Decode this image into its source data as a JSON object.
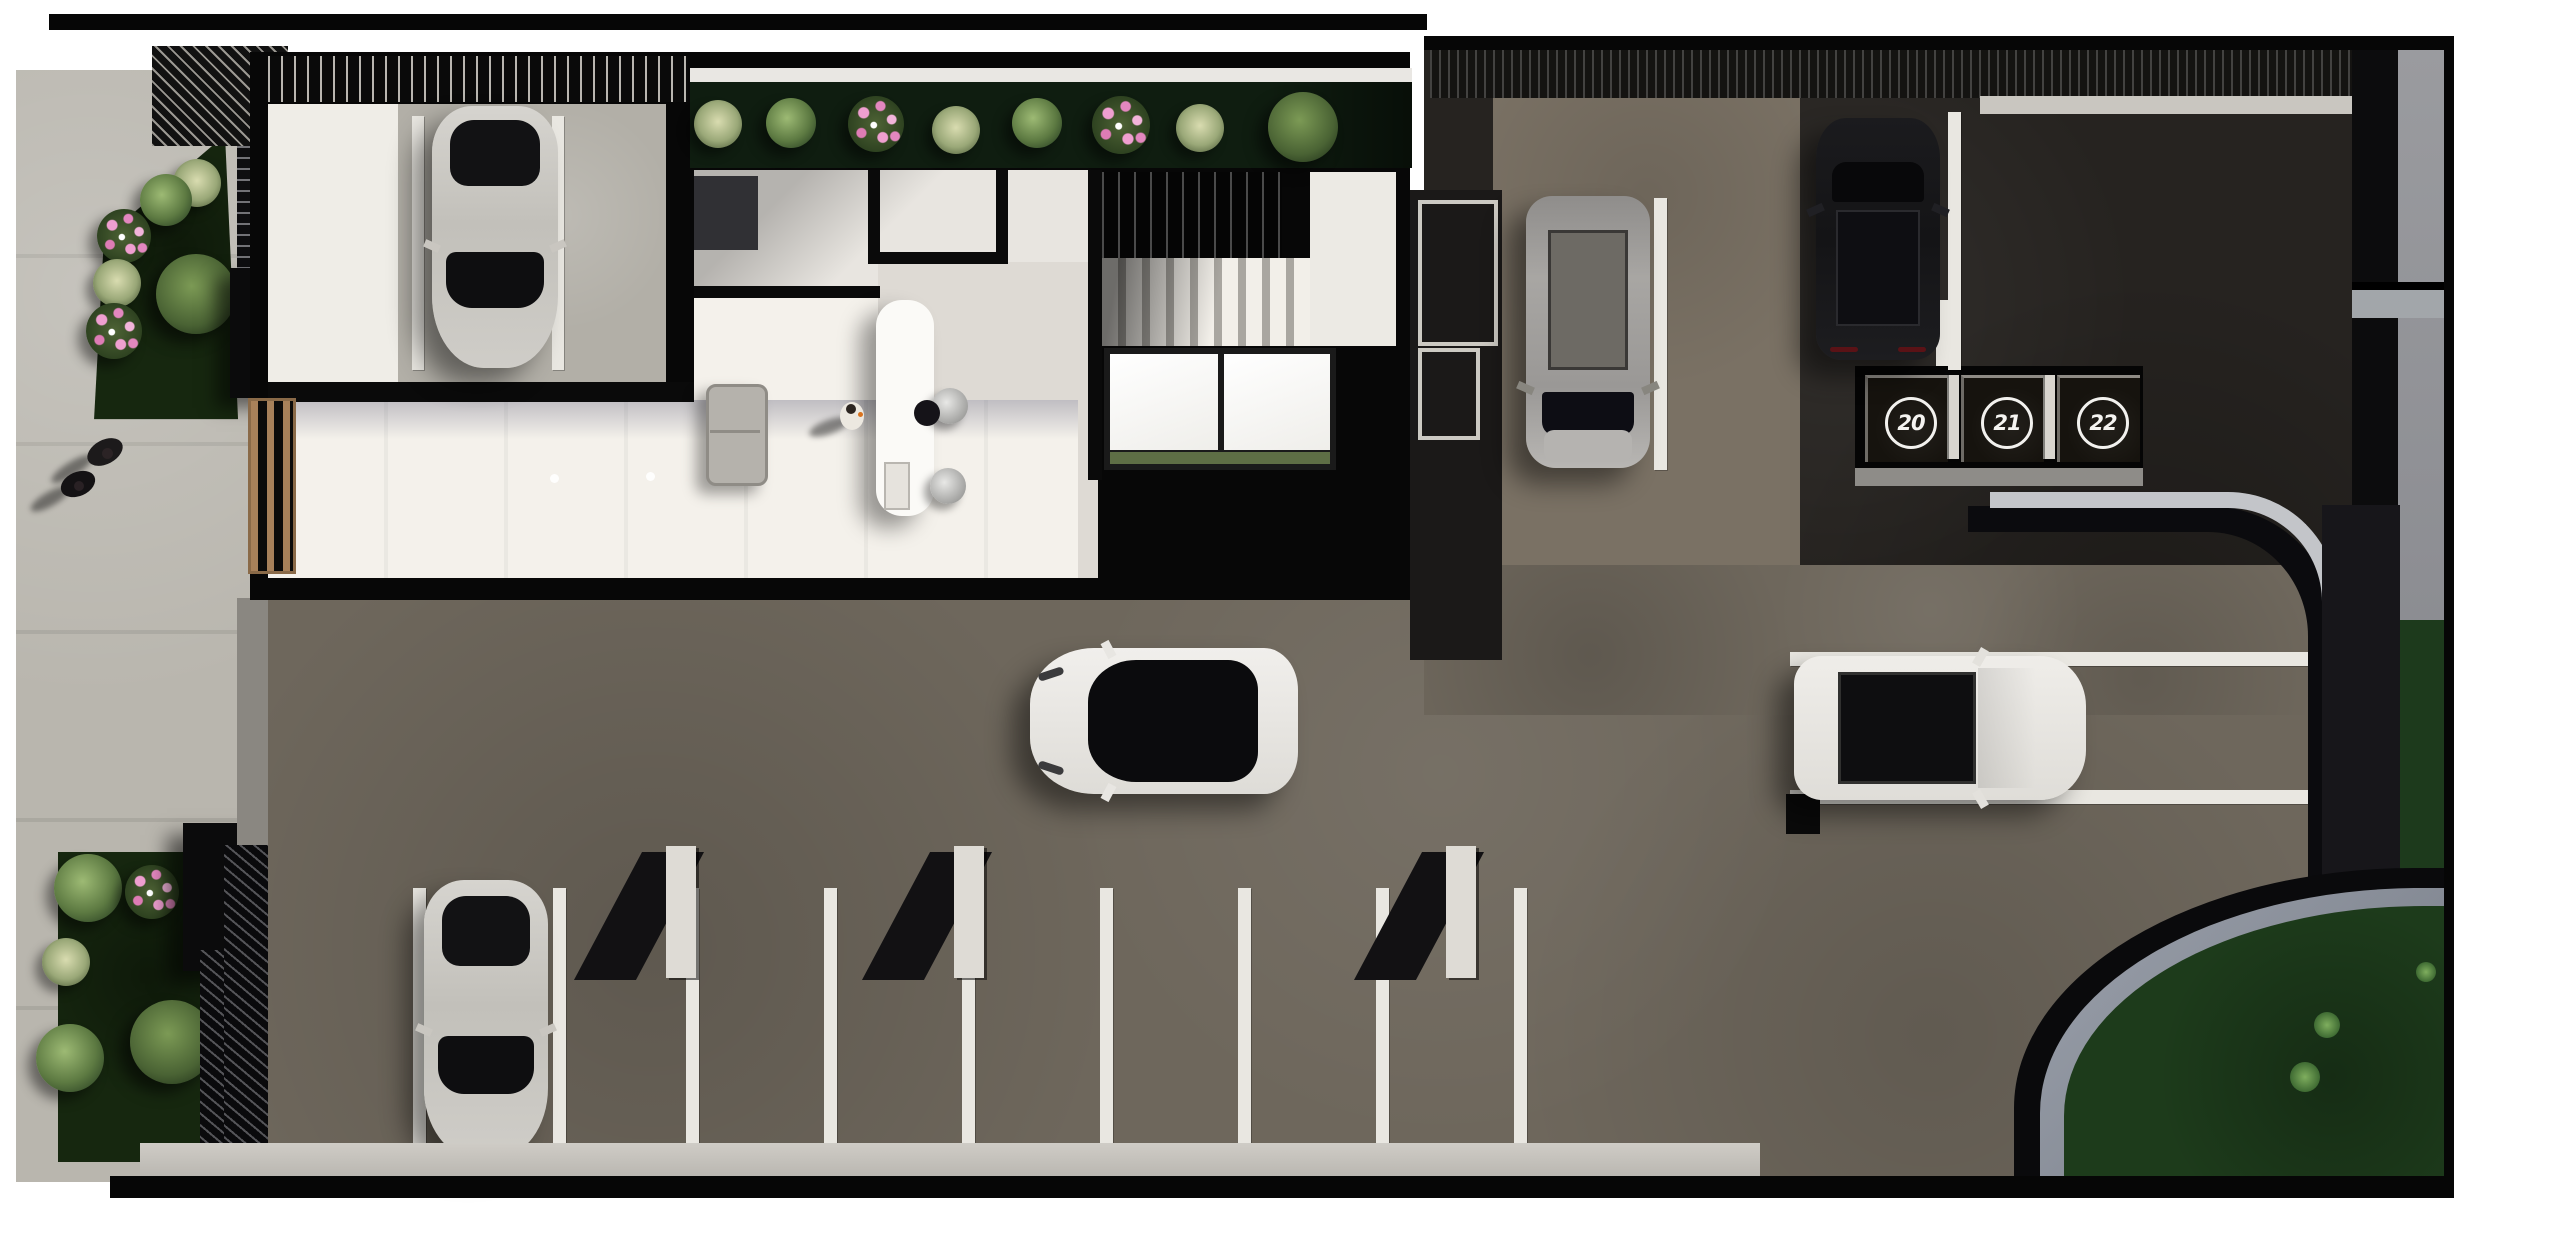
{
  "scene": {
    "description": "Top-down 3D architectural rendering of a building ground floor with lobby, covered garage, roof planting strip, gardens, sidewalks and a parking lot with marked stalls",
    "numbered_spots": [
      {
        "label": "20"
      },
      {
        "label": "21"
      },
      {
        "label": "22"
      }
    ],
    "cars": [
      {
        "id": "garage-car",
        "color_hex": "#c9c6c0",
        "description": "silver car parked in covered stall beside the building, facing down"
      },
      {
        "id": "street-car",
        "color_hex": "#c9c6c0",
        "description": "silver car parked in the lower-left stall of the lot, facing down"
      },
      {
        "id": "silver-suv",
        "color_hex": "#9a9896",
        "description": "gray SUV parked along the building's right side, facing down"
      },
      {
        "id": "black-suv",
        "color_hex": "#17171a",
        "description": "black SUV parked in the upper-right stall, facing up"
      },
      {
        "id": "white-sedan",
        "color_hex": "#eceae6",
        "description": "white sedan with black glass canopy in the center aisle, facing left"
      },
      {
        "id": "white-suv",
        "color_hex": "#e9e7e3",
        "description": "white SUV with black roof parked in the right bay, facing right"
      }
    ],
    "people": [
      {
        "id": "pedestrian-1",
        "location": "left sidewalk"
      },
      {
        "id": "pedestrian-2",
        "location": "left sidewalk"
      },
      {
        "id": "receptionist",
        "location": "behind lobby desk"
      },
      {
        "id": "visitor",
        "location": "lobby floor"
      }
    ],
    "palette": {
      "background": "#ffffff",
      "sidewalk": "#b9b6ae",
      "asphalt_light": "#6e675c",
      "asphalt_dark": "#262320",
      "building_wall": "#070707",
      "interior_floor": "#f4f1eb",
      "garden_green": "#16270f",
      "lawn_green": "#1d3b1b",
      "roof_planter": "#0f1d10",
      "parking_line": "#e9e7e1",
      "wood_gate": "#a8815a",
      "flower_pink": "#e89cc5"
    }
  }
}
